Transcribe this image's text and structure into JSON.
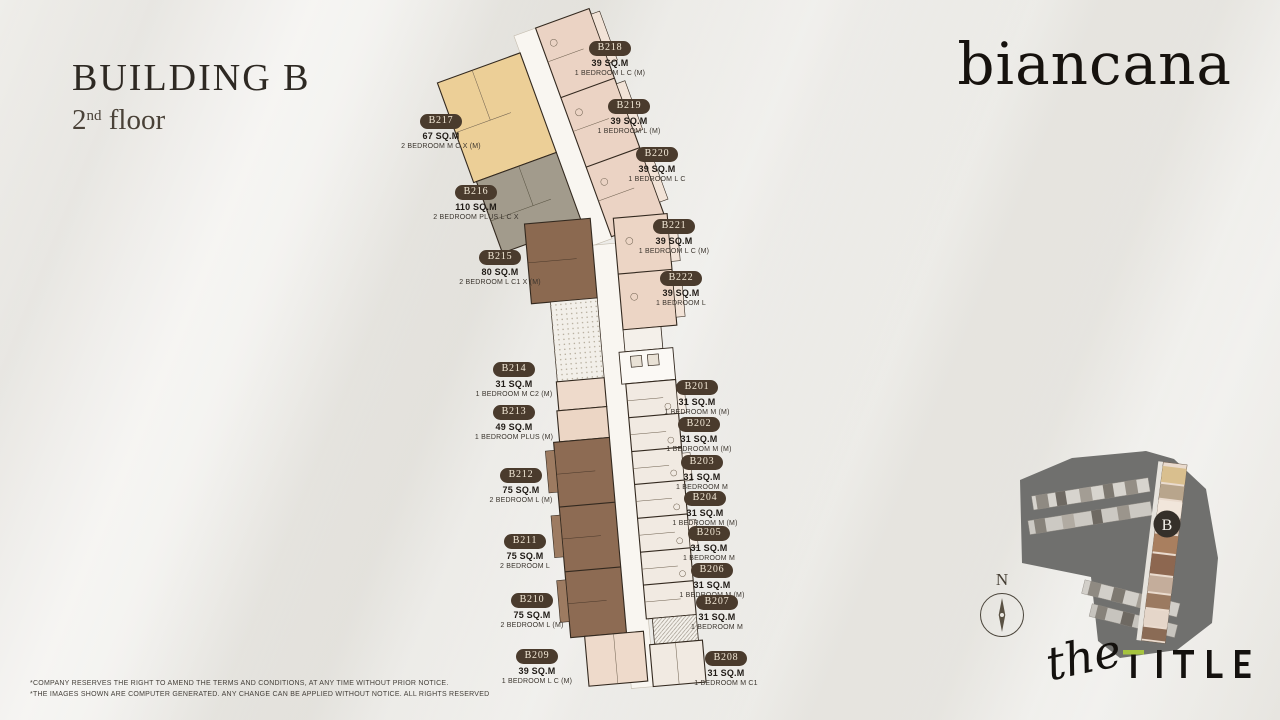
{
  "header": {
    "building": "BUILDING B",
    "floor_number": "2",
    "floor_ordinal": "nd",
    "floor_word": "floor"
  },
  "brand": {
    "name": "biancana"
  },
  "units": [
    {
      "id": "B201",
      "area": "31 SQ.M",
      "type": "1 BEDROOM M (M)"
    },
    {
      "id": "B202",
      "area": "31 SQ.M",
      "type": "1 BEDROOM M (M)"
    },
    {
      "id": "B203",
      "area": "31 SQ.M",
      "type": "1 BEDROOM M"
    },
    {
      "id": "B204",
      "area": "31 SQ.M",
      "type": "1 BEDROOM M (M)"
    },
    {
      "id": "B205",
      "area": "31 SQ.M",
      "type": "1 BEDROOM M"
    },
    {
      "id": "B206",
      "area": "31 SQ.M",
      "type": "1 BEDROOM M (M)"
    },
    {
      "id": "B207",
      "area": "31 SQ.M",
      "type": "1 BEDROOM M"
    },
    {
      "id": "B208",
      "area": "31 SQ.M",
      "type": "1 BEDROOM M C1"
    },
    {
      "id": "B209",
      "area": "39 SQ.M",
      "type": "1 BEDROOM L C (M)"
    },
    {
      "id": "B210",
      "area": "75 SQ.M",
      "type": "2 BEDROOM L (M)"
    },
    {
      "id": "B211",
      "area": "75 SQ.M",
      "type": "2 BEDROOM L"
    },
    {
      "id": "B212",
      "area": "75 SQ.M",
      "type": "2 BEDROOM L (M)"
    },
    {
      "id": "B213",
      "area": "49 SQ.M",
      "type": "1 BEDROOM PLUS (M)"
    },
    {
      "id": "B214",
      "area": "31 SQ.M",
      "type": "1 BEDROOM M C2 (M)"
    },
    {
      "id": "B215",
      "area": "80 SQ.M",
      "type": "2 BEDROOM L C1 X (M)"
    },
    {
      "id": "B216",
      "area": "110 SQ.M",
      "type": "2 BEDROOM PLUS L C X"
    },
    {
      "id": "B217",
      "area": "67 SQ.M",
      "type": "2 BEDROOM M C X (M)"
    },
    {
      "id": "B218",
      "area": "39 SQ.M",
      "type": "1 BEDROOM L C (M)"
    },
    {
      "id": "B219",
      "area": "39 SQ.M",
      "type": "1 BEDROOM L (M)"
    },
    {
      "id": "B220",
      "area": "39 SQ.M",
      "type": "1 BEDROOM L C"
    },
    {
      "id": "B221",
      "area": "39 SQ.M",
      "type": "1 BEDROOM L C (M)"
    },
    {
      "id": "B222",
      "area": "39 SQ.M",
      "type": "1 BEDROOM L"
    }
  ],
  "footer": {
    "line1": "*COMPANY RESERVES THE RIGHT TO AMEND THE TERMS AND CONDITIONS, AT ANY TIME WITHOUT PRIOR NOTICE.",
    "line2": "*THE IMAGES SHOWN ARE COMPUTER GENERATED. ANY CHANGE CAN BE APPLIED WITHOUT NOTICE. ALL RIGHTS RESERVED"
  },
  "compass": {
    "north_label": "N"
  },
  "site_map": {
    "building_marker": "B"
  },
  "logo": {
    "script": "the",
    "main": "TITLE"
  },
  "colors": {
    "badge": "#4a3b2d",
    "badge_text": "#f3e9d7",
    "accent_green": "#a6c43f",
    "unit_tan": "#eccf97",
    "unit_gray": "#a29b8c",
    "unit_brown": "#8d6b53",
    "unit_pink": "#ecd5c5",
    "unit_light": "#f1eae2",
    "corridor": "#f9f6f1",
    "sitemap_gray": "#70706e"
  }
}
